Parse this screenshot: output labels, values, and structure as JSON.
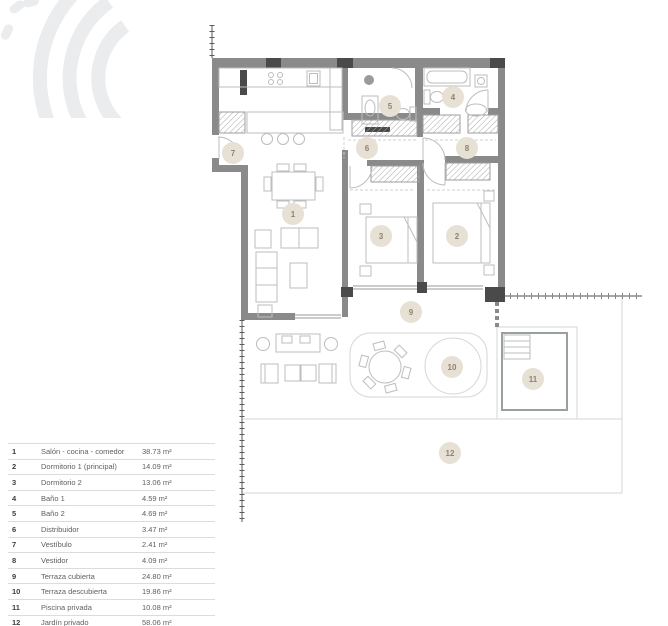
{
  "legend": {
    "rows": [
      {
        "num": "1",
        "name": "Salón - cocina - comedor",
        "area": "38.73 m²"
      },
      {
        "num": "2",
        "name": "Dormitorio 1 (principal)",
        "area": "14.09 m²"
      },
      {
        "num": "3",
        "name": "Dormitorio 2",
        "area": "13.06 m²"
      },
      {
        "num": "4",
        "name": "Baño 1",
        "area": "4.59 m²"
      },
      {
        "num": "5",
        "name": "Baño 2",
        "area": "4.69 m²"
      },
      {
        "num": "6",
        "name": "Distribuidor",
        "area": "3.47 m²"
      },
      {
        "num": "7",
        "name": "Vestíbulo",
        "area": "2.41 m²"
      },
      {
        "num": "8",
        "name": "Vestidor",
        "area": "4.09 m²"
      },
      {
        "num": "9",
        "name": "Terraza cubierta",
        "area": "24.80 m²"
      },
      {
        "num": "10",
        "name": "Terraza descubierta",
        "area": "19.86 m²"
      },
      {
        "num": "11",
        "name": "Piscina privada",
        "area": "10.08 m²"
      },
      {
        "num": "12",
        "name": "Jardín privado",
        "area": "58.06 m²"
      }
    ]
  },
  "plan": {
    "badges": [
      {
        "n": "1"
      },
      {
        "n": "2"
      },
      {
        "n": "3"
      },
      {
        "n": "4"
      },
      {
        "n": "5"
      },
      {
        "n": "6"
      },
      {
        "n": "7"
      },
      {
        "n": "8"
      },
      {
        "n": "9"
      },
      {
        "n": "10"
      },
      {
        "n": "11"
      },
      {
        "n": "12"
      }
    ]
  },
  "colors": {
    "wall": "#8a8a8a",
    "wall_dark": "#4a4a4a",
    "furn": "#bdbdbd",
    "outline": "#d6d6d6",
    "glass": "#9a9a9a",
    "hatch_stroke": "#9e9e9e",
    "boundary": "#5a5a5a",
    "badge_fill": "#e7e0d4",
    "badge_text": "#8e8372",
    "legend_line": "#dcdcdc",
    "text_dark": "#3d3d3d",
    "text_gray": "#5f5f5f",
    "logo": "#eaeced"
  }
}
